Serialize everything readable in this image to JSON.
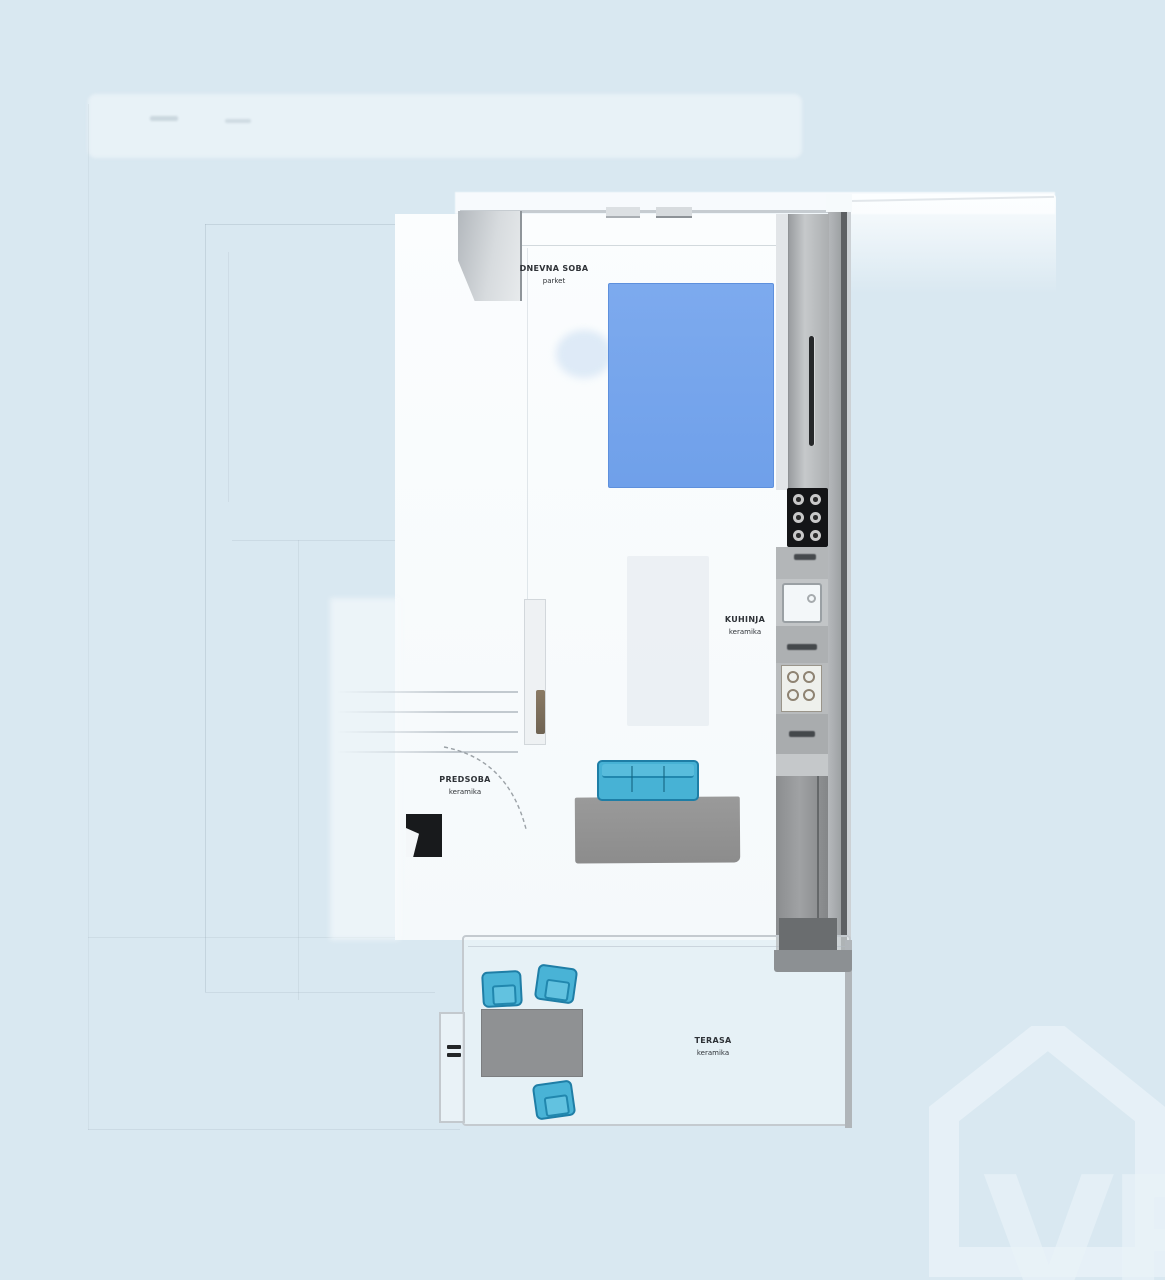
{
  "rooms": [
    {
      "name": "DNEVNA SOBA",
      "floor": "parket"
    },
    {
      "name": "KUHINJA",
      "floor": "keramika"
    },
    {
      "name": "PREDSOBA",
      "floor": "keramika"
    },
    {
      "name": "TERASA",
      "floor": "keramika"
    }
  ],
  "watermark": {
    "text": "VR"
  },
  "colors": {
    "background": "#d9e8f1",
    "rug_blue": "#74a3ec",
    "furniture_teal": "#49b3d6",
    "furniture_outline": "#1f7ea6",
    "table_gray": "#8f9193",
    "cabinet_gray": "#abaeb0",
    "wall_dark": "#5d6063",
    "appliance_black": "#141517"
  }
}
